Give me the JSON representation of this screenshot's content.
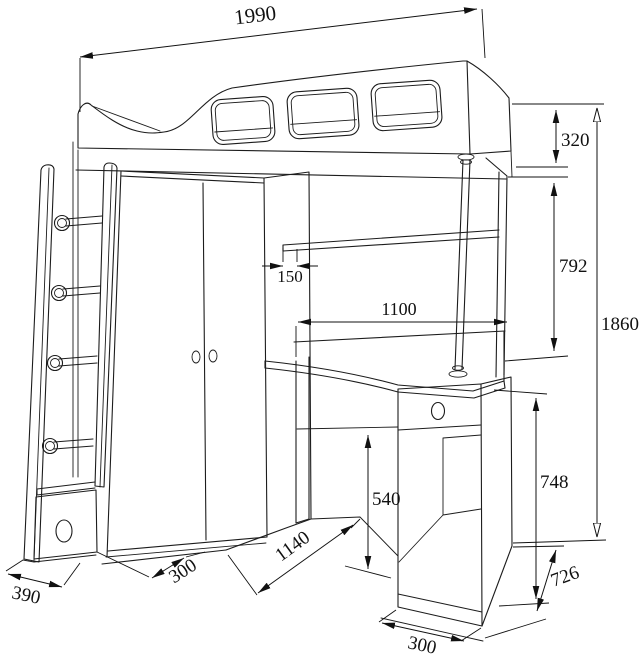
{
  "drawing": {
    "type": "furniture-technical-drawing",
    "subject": "loft bed with wardrobe, corner desk, drawer cabinet and ladder",
    "units": "mm",
    "dimensions": {
      "bed_length": "1990",
      "guard_rail_height": "320",
      "under_bed_clearance": "792",
      "overall_height": "1860",
      "shelf_depth": "150",
      "desk_length": "1100",
      "under_desk_clearance": "540",
      "desk_height": "748",
      "desk_depth": "726",
      "cabinet_width": "300",
      "front_span": "1140",
      "wardrobe_depth": "300",
      "ladder_depth": "390"
    }
  }
}
